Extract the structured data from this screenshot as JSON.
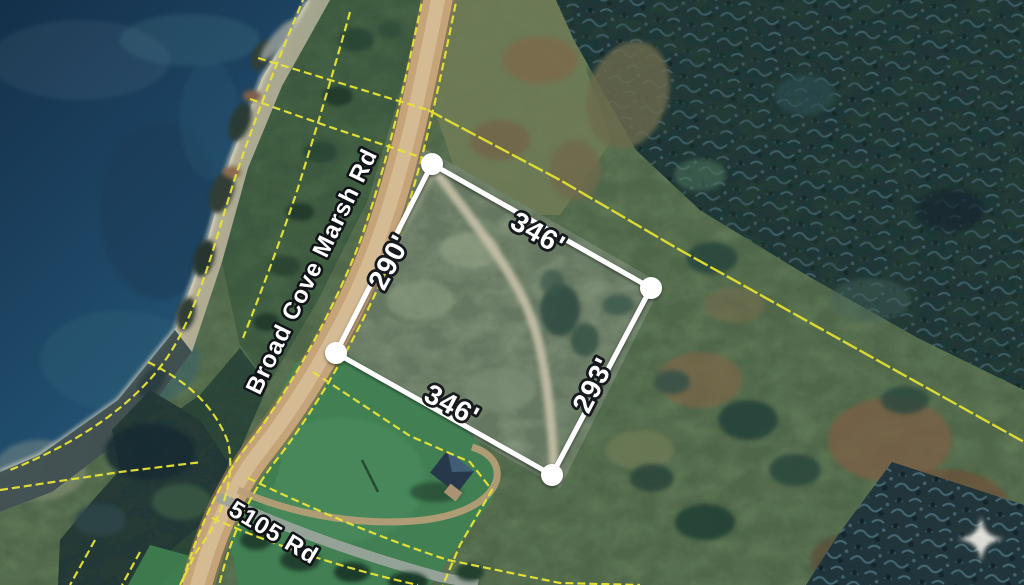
{
  "map": {
    "imagery": "satellite",
    "roads": [
      {
        "id": "broad-cove-marsh-rd",
        "label": "Broad Cove Marsh Rd"
      },
      {
        "id": "5105-rd",
        "label": "5105 Rd"
      }
    ],
    "parcel": {
      "boundary_color": "#ffffff",
      "corner_count": 4,
      "measurements": [
        {
          "edge": "northeast",
          "value": "346'"
        },
        {
          "edge": "northwest",
          "value": "290'"
        },
        {
          "edge": "southwest",
          "value": "346'"
        },
        {
          "edge": "southeast",
          "value": "293'"
        }
      ]
    },
    "overlay": {
      "cadastral_line_color": "#e8e436",
      "sparkle_color": "#f7f4ea"
    }
  }
}
